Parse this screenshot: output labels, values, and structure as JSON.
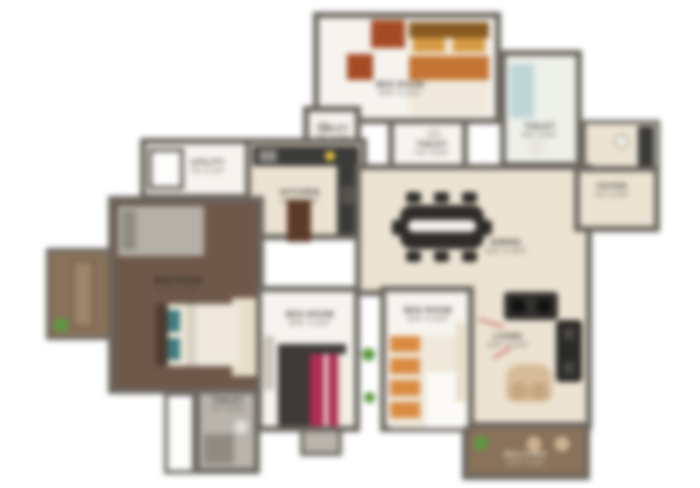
{
  "plan_title": "apartment-floor-plan",
  "rooms": {
    "bedroom_top": {
      "name": "BED ROOM",
      "dims": "10'6\" X 12'0\""
    },
    "toilet_top_left": {
      "name": "TOILET",
      "dims": "7'0\" X 5'0\""
    },
    "toilet_mid": {
      "name": "TOILET",
      "dims": "7'6\" X 5'0\""
    },
    "toilet_top_right": {
      "name": "TOILET",
      "dims": "8'0\" X 5'0\""
    },
    "wash": {
      "name": "WASH",
      "dims": ""
    },
    "utility": {
      "name": "UTILITY",
      "dims": "7'6\" X 4'0\""
    },
    "kitchen": {
      "name": "KITCHEN",
      "dims": "10'0\" X 8'6\""
    },
    "foyer": {
      "name": "FOYER",
      "dims": "7'0\" X 4'6\""
    },
    "dining": {
      "name": "DINING",
      "dims": "12'6\" X 10'0\""
    },
    "living": {
      "name": "LIVING",
      "dims": "13'0\" X 11'0\""
    },
    "bedroom_master": {
      "name": "BED ROOM",
      "dims": "11'0\" X 12'0\""
    },
    "bedroom_left": {
      "name": "BED ROOM",
      "dims": "10'0\" X 11'6\""
    },
    "bedroom_right": {
      "name": "BED ROOM",
      "dims": "10'0\" X 11'6\""
    },
    "toilet_bottom": {
      "name": "TOILET",
      "dims": "7'0\" X 5'0\""
    },
    "balcony": {
      "name": "BALCONY",
      "dims": "12'0\" X 5'0\""
    },
    "deck": {
      "name": "DECK",
      "dims": ""
    }
  },
  "colors": {
    "wall": "#6a665e",
    "floor_cream": "#ece3d1",
    "floor_white": "#f6f4ef",
    "floor_wood": "#6f5848",
    "deck_wood": "#8a7258",
    "counter_dark": "#3a3a38",
    "accent_orange": "#c9722e",
    "accent_rust": "#a84a20",
    "accent_magenta": "#b52b55",
    "accent_teal": "#3e7d80",
    "plant_green": "#5a9a3c",
    "shower_blue": "#bcd6d8"
  }
}
